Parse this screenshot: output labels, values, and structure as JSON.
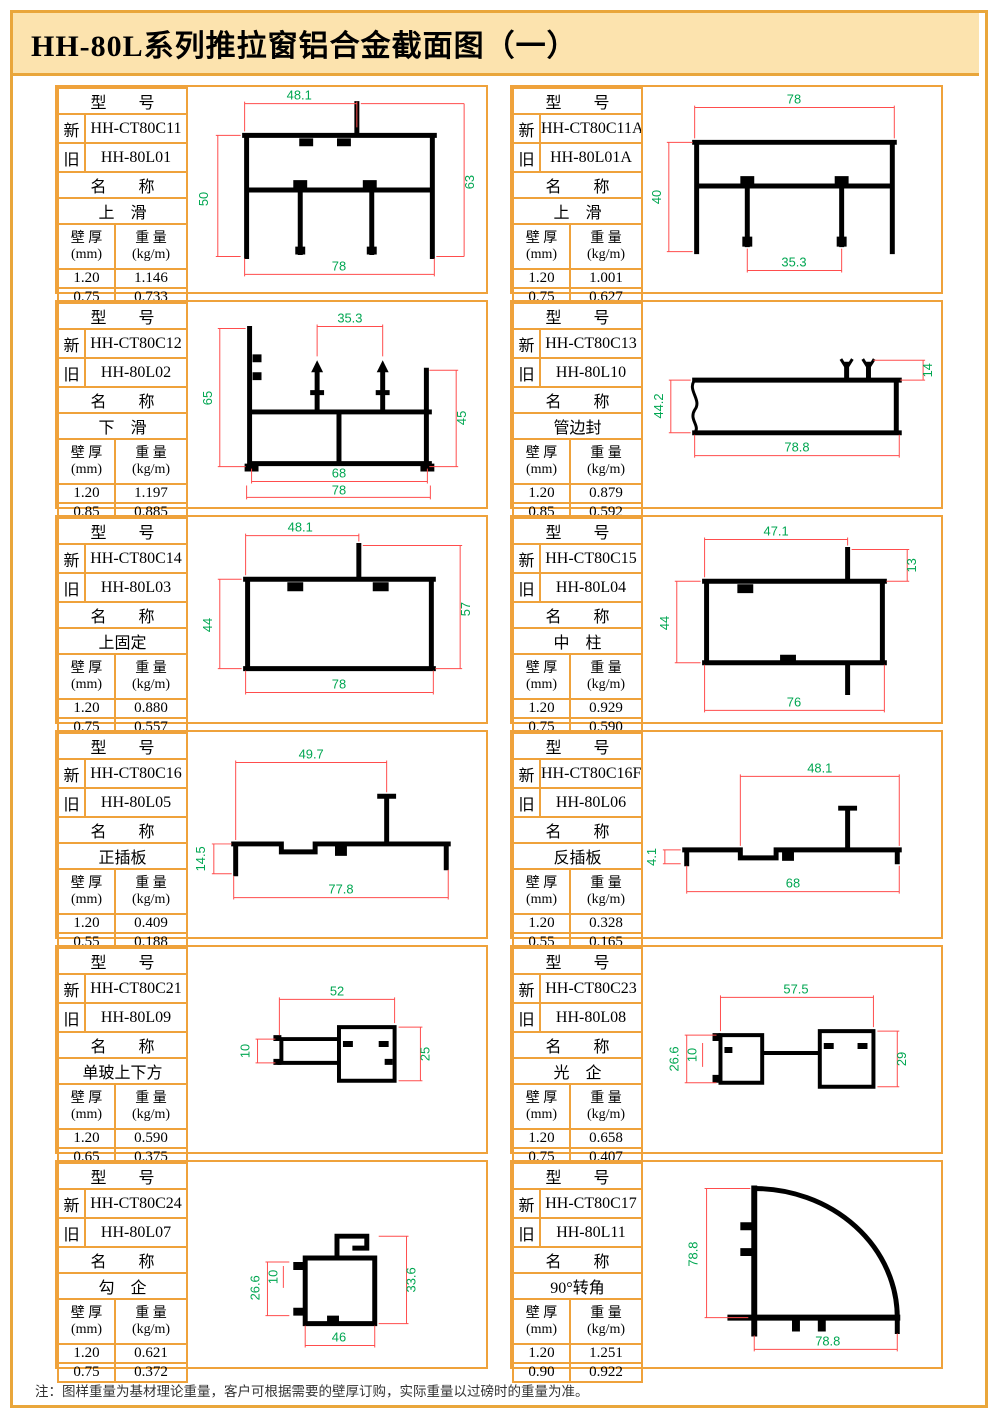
{
  "page": {
    "title": "HH-80L系列推拉窗铝合金截面图（一）",
    "footnote": "注：图样重量为基材理论重量，客户可根据需要的壁厚订购，实际重量以过磅时的重量为准。"
  },
  "labels": {
    "model": "型　　号",
    "new": "新",
    "old": "旧",
    "name": "名　　称",
    "thickness": "壁 厚",
    "thickness_unit": "(mm)",
    "weight": "重 量",
    "weight_unit": "(kg/m)"
  },
  "colors": {
    "border_orange": "#EFA23B",
    "old_model_red": "#FF0000",
    "dimension_line_red": "#FF4D4D",
    "dimension_text_green": "#00A651",
    "title_band": "#FCE3AE",
    "profile_black": "#000000"
  },
  "cells": [
    {
      "new_model": "HH-CT80C11",
      "old_model": "HH-80L01",
      "name": "上　滑",
      "rows": [
        [
          "1.20",
          "1.146"
        ],
        [
          "0.75",
          "0.733"
        ]
      ],
      "dims": {
        "top": "48.1",
        "left": "50",
        "right": "63",
        "bottom": "78"
      }
    },
    {
      "new_model": "HH-CT80C11A",
      "old_model": "HH-80L01A",
      "name": "上　滑",
      "rows": [
        [
          "1.20",
          "1.001"
        ],
        [
          "0.75",
          "0.627"
        ]
      ],
      "dims": {
        "top": "78",
        "left": "40",
        "bottom": "35.3"
      }
    },
    {
      "new_model": "HH-CT80C12",
      "old_model": "HH-80L02",
      "name": "下　滑",
      "rows": [
        [
          "1.20",
          "1.197"
        ],
        [
          "0.85",
          "0.885"
        ]
      ],
      "dims": {
        "top": "35.3",
        "left": "65",
        "right": "45",
        "inner": "68",
        "bottom": "78"
      }
    },
    {
      "new_model": "HH-CT80C13",
      "old_model": "HH-80L10",
      "name": "管边封",
      "rows": [
        [
          "1.20",
          "0.879"
        ],
        [
          "0.85",
          "0.592"
        ]
      ],
      "dims": {
        "left": "44.2",
        "right": "14",
        "bottom": "78.8"
      }
    },
    {
      "new_model": "HH-CT80C14",
      "old_model": "HH-80L03",
      "name": "上固定",
      "rows": [
        [
          "1.20",
          "0.880"
        ],
        [
          "0.75",
          "0.557"
        ]
      ],
      "dims": {
        "top": "48.1",
        "left": "44",
        "right": "57",
        "bottom": "78"
      }
    },
    {
      "new_model": "HH-CT80C15",
      "old_model": "HH-80L04",
      "name": "中　柱",
      "rows": [
        [
          "1.20",
          "0.929"
        ],
        [
          "0.75",
          "0.590"
        ]
      ],
      "dims": {
        "top": "47.1",
        "right": "13",
        "left": "44",
        "bottom": "76"
      }
    },
    {
      "new_model": "HH-CT80C16",
      "old_model": "HH-80L05",
      "name": "正插板",
      "rows": [
        [
          "1.20",
          "0.409"
        ],
        [
          "0.55",
          "0.188"
        ]
      ],
      "dims": {
        "top": "49.7",
        "left": "14.5",
        "bottom": "77.8"
      }
    },
    {
      "new_model": "HH-CT80C16F",
      "old_model": "HH-80L06",
      "name": "反插板",
      "rows": [
        [
          "1.20",
          "0.328"
        ],
        [
          "0.55",
          "0.165"
        ]
      ],
      "dims": {
        "top": "48.1",
        "left": "4.1",
        "bottom": "68"
      }
    },
    {
      "new_model": "HH-CT80C21",
      "old_model": "HH-80L09",
      "name": "单玻上下方",
      "rows": [
        [
          "1.20",
          "0.590"
        ],
        [
          "0.65",
          "0.375"
        ]
      ],
      "dims": {
        "top": "52",
        "left": "10",
        "right": "25"
      }
    },
    {
      "new_model": "HH-CT80C23",
      "old_model": "HH-80L08",
      "name": "光　企",
      "rows": [
        [
          "1.20",
          "0.658"
        ],
        [
          "0.75",
          "0.407"
        ]
      ],
      "dims": {
        "top": "57.5",
        "left": "26.6",
        "left2": "10",
        "right": "29"
      }
    },
    {
      "new_model": "HH-CT80C24",
      "old_model": "HH-80L07",
      "name": "勾　企",
      "rows": [
        [
          "1.20",
          "0.621"
        ],
        [
          "0.75",
          "0.372"
        ]
      ],
      "dims": {
        "left": "26.6",
        "left2": "10",
        "right": "33.6",
        "bottom": "46"
      }
    },
    {
      "new_model": "HH-CT80C17",
      "old_model": "HH-80L11",
      "name": "90°转角",
      "rows": [
        [
          "1.20",
          "1.251"
        ],
        [
          "0.90",
          "0.922"
        ]
      ],
      "dims": {
        "left": "78.8",
        "bottom": "78.8"
      }
    }
  ]
}
